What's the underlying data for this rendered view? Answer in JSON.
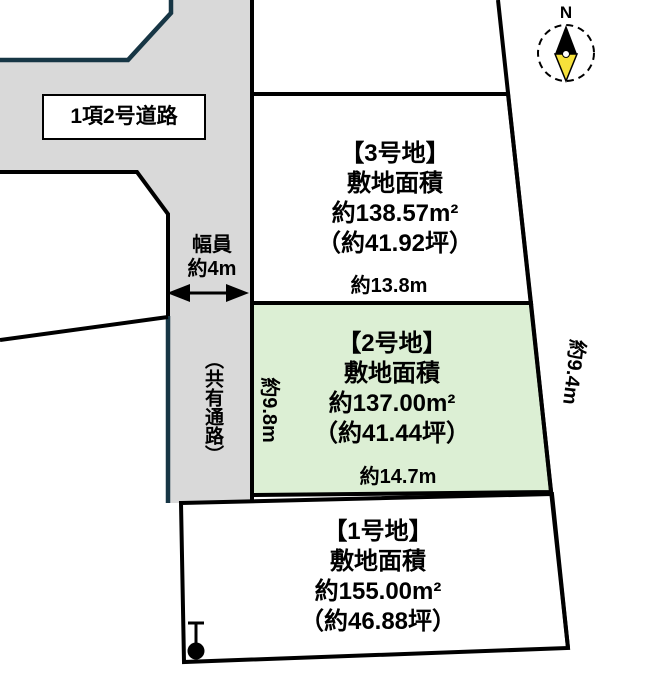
{
  "road": {
    "label": "1項2号道路"
  },
  "passage": {
    "width_line1": "幅員",
    "width_line2": "約4m",
    "name": "（共有通路）"
  },
  "compass": {
    "north": "N"
  },
  "dimensions": {
    "lot2_top": "約13.8m",
    "lot2_bottom": "約14.7m",
    "lot2_left": "約9.8m",
    "lot2_right": "約9.4m"
  },
  "lots": {
    "lot3": {
      "title": "【3号地】",
      "area_caption": "敷地面積",
      "area_m2": "約138.57m²",
      "area_tsubo": "（約41.92坪）"
    },
    "lot2": {
      "title": "【2号地】",
      "area_caption": "敷地面積",
      "area_m2": "約137.00m²",
      "area_tsubo": "（約41.44坪）"
    },
    "lot1": {
      "title": "【1号地】",
      "area_caption": "敷地面積",
      "area_m2": "約155.00m²",
      "area_tsubo": "（約46.88坪）"
    }
  },
  "colors": {
    "road_fill": "#d9d9d9",
    "lot2_highlight": "#dcefd4",
    "boundary_navy": "#173645",
    "line_black": "#000000",
    "compass_yellow": "#f6e13b"
  }
}
